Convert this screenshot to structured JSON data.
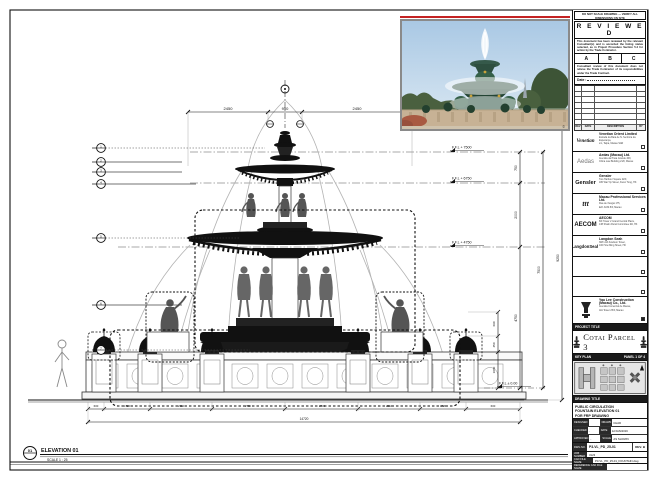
{
  "sheet": {
    "note_top": "DO NOT SCALE DRAWING — VERIFY ALL DIMENSIONS ON SITE",
    "stamp": {
      "title": "R E V I E W E D",
      "para1": "This document has been reviewed by the relevant Consultant(s) and is accorded the listing status selected, as in Project Procedure Section 5.4 for action by the Trade Contractor.",
      "options": [
        "A",
        "B",
        "C"
      ],
      "para2": "Consultant review of this document does not relieve the Trade Contractor of its responsibilities under the Trade Contract.",
      "date_label": "Date :"
    },
    "rev_headers": {
      "rev": "REV",
      "date": "DATE",
      "desc": "DESCRIPTION",
      "by": "BY"
    },
    "consultants": [
      {
        "logo": "Venetian",
        "name": "Venetian Orient Limited",
        "addr1": "Estrada da Baía de N. Senhora da Esperança,",
        "addr2": "s/n, Taipa, Macau SAR"
      },
      {
        "logo": "Aedas",
        "name": "Aedas (Macau) Ltd.",
        "addr1": "Avenida da Praia Grande 409,",
        "addr2": "China Law Building 21/F, Macau"
      },
      {
        "logo": "Gensler",
        "name": "Gensler",
        "addr1": "Two Harbour Square 22/F,",
        "addr2": "180 Wai Yip Street, Kwun Tong, HK"
      },
      {
        "logo": "ttt",
        "name": "Macau Professional Services Ltd.",
        "addr1": "Rua de Xangai 175,",
        "addr2": "Edf. ACM 8/F, Macau"
      },
      {
        "logo": "AECOM",
        "name": "AECOM",
        "addr1": "8/F Tower 2 Grand Central Plaza,",
        "addr2": "138 Shatin Rural Committee Rd, HK"
      },
      {
        "logo": "LangdonSeah",
        "name": "Langdon Seah",
        "addr1": "38/F AIA Kowloon Tower,",
        "addr2": "100 How Ming Street, HK"
      }
    ],
    "contractor": {
      "name": "Yau Lee Construction (Macau) Co., Ltd.",
      "addr1": "Avenida Comercial de Macau,",
      "addr2": "AIA Tower 25/F, Macau"
    },
    "project_title_label": "PROJECT TITLE",
    "project_title": "Cotai Parcel 3",
    "key_plan_label": "KEY PLAN",
    "panel_label": "PANEL 1 OF 4",
    "drawing_title_label": "DRAWING TITLE",
    "title_line1": "PUBLIC CIRCULATION",
    "title_line2": "FOUNTAIN ELEVATION 01",
    "title_line3": "FOR FRP DRAWING",
    "fields": {
      "designed_label": "DESIGNED",
      "designed": "",
      "drawn_label": "DRAWN",
      "drawn": "CHAD",
      "checked_label": "CHECKED",
      "checked": "-",
      "date_label": "DATE",
      "date": "12/JAN/2016",
      "approved_label": "APPROVED",
      "approved": "-",
      "scale_label": "SCALE",
      "scale": "AS SHOWN",
      "dwg_label": "DWG NO.",
      "dwg_no": "P3-VL_PD_25-01",
      "rev": "REV. B",
      "job_label": "JOB NUMBER",
      "job": "3123",
      "cad_label": "CAD FILE NAME",
      "cad": "P3-VL_PD_25-01_FOUNTAIN.dwg",
      "ref_label": "REFERENCE CAD FILE NAME",
      "ref": ""
    }
  },
  "drawing": {
    "levels": [
      "F.F.L + 7500",
      "F.F.L + 6750",
      "F.F.L + 4750",
      "F.F.L ± 0.00"
    ],
    "hdims_top": [
      "2450",
      "950",
      "2450"
    ],
    "vdims_right": [
      "750",
      "2000",
      "4750",
      "7500",
      "9250"
    ],
    "vdims_small": [
      "690",
      "450",
      "1060"
    ],
    "hdims_bottom": [
      "600",
      "1720",
      "2310",
      "2730",
      "2730",
      "2310",
      "1720",
      "600"
    ],
    "total_dim": "14720",
    "keynotes": [
      "1",
      "2",
      "3",
      "4",
      "5",
      "6",
      "7"
    ],
    "callout_num": "01",
    "callout_title": "ELEVATION 01",
    "callout_scale": "SCALE 1 : 25"
  },
  "photo": {
    "watermark": "©"
  },
  "colors": {
    "accent_red": "#c32222",
    "ink": "#111111",
    "patina": "#2f4f3f"
  }
}
